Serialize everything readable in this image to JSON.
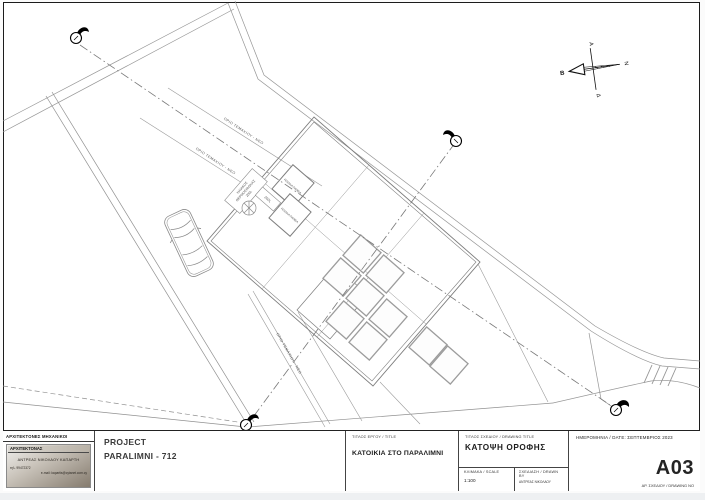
{
  "drawing": {
    "compass": {
      "north_label": "Β",
      "south_label": "Ν",
      "east_label": "Α",
      "west_label": "Δ"
    },
    "boundary_labels": [
      "ΟΡΙΟ ΤΕΜΑΧΙΟΥ - ΝΕΟ",
      "ΟΡΙΟ ΤΕΜΑΧΙΟΥ - ΝΕΟ",
      "ΟΡΙΟ ΤΕΜΑΧΙΟΥ - ΝΕΟ"
    ],
    "roof": {
      "heater_line_1": "ΗΛΙΑΚΟΣ",
      "heater_line_2": "ΘΕΡΜΟΣΙΦΩΝΑΣ",
      "heater_line_3": "200L",
      "tank_label": "200L",
      "panel_label_1": "ΗΛΙΑΚΑ ΠΑΝΕΛ",
      "panel_label_2": "ΗΛΙΑΚΑ ΠΑΝΕΛ"
    }
  },
  "title_block": {
    "firm_header": "ΑΡΧΙΤΕΚΤΟΝΕΣ ΜΗΧΑΝΙΚΟΙ",
    "architect_label": "ΑΡΧΙΤΕΚΤΟΝΑΣ",
    "architect_name": "ΑΝΤΡΕΑΣ ΝΙΚΟΛΑΟΥ ΚΑΠΑΡΤΗ",
    "architect_phone": "τηλ. 99472372",
    "architect_email": "e-mail: kapartis@cytanet.com.cy",
    "project_label": "PROJECT",
    "project_name": "PARALIMNI - 712",
    "title_label": "ΤΙΤΛΟΣ ΕΡΓΟΥ / TITLE",
    "title_value": "ΚΑΤΟΙΚΙΑ ΣΤΟ ΠΑΡΑΛΙΜΝΙ",
    "drawing_title_label": "ΤΙΤΛΟΣ ΣΧΕΔΙΟΥ / DRAWING TITLE",
    "drawing_title_value": "ΚΑΤΟΨΗ  ΟΡΟΦΗΣ",
    "scale_label": "ΚΛΙΜΑΚΑ / SCALE",
    "scale_value": "1:100",
    "drawn_by_label": "ΣΧΕΔΙΑΣΗ / DRAWN BY",
    "drawn_by_value": "ΑΝΤΡΕΑΣ ΝΙΚΟΛΑΟΥ",
    "date_label": "ΗΜΕΡΟΜΗΝΙΑ / DATE:",
    "date_value": "ΣΕΠΤΕΜΒΡΙΟΣ 2023",
    "drawing_no_value": "A03",
    "drawing_no_label": "ΑΡ. ΣΧΕΔΙΟΥ / DRAWING NO"
  }
}
